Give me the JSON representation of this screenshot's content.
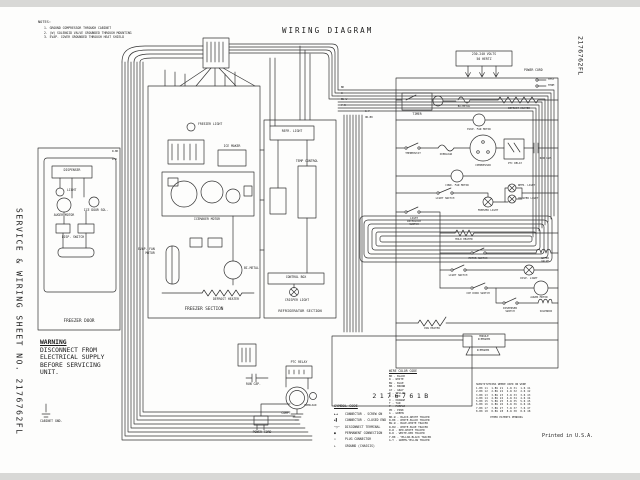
{
  "page": {
    "title": "WIRING DIAGRAM",
    "side_left": "SERVICE & WIRING SHEET NO. 2176762FL",
    "side_right": "2176762FL",
    "printed": "Printed in U.S.A.",
    "diagram_number": "2176761B"
  },
  "notes": {
    "heading": "NOTES:",
    "items": [
      "1. GROUND COMPRESSOR THROUGH CABINET",
      "2. (W) SOLENOID VALVE GROUNDED THROUGH MOUNTING",
      "3. EVAP. COVER GROUNDED THROUGH HEAT SHIELD"
    ]
  },
  "warning": {
    "title": "WARNING",
    "lines": "DISCONNECT FROM\nELECTRICAL SUPPLY\nBEFORE SERVICING\nUNIT."
  },
  "pictorial": {
    "freezer_door": {
      "title": "FREEZER DOOR",
      "dispenser": "DISPENSER",
      "light": "LIGHT",
      "auger": "AUGER MOTOR",
      "ice_door": "ICE DOOR SOL.",
      "switch": "DISP. SWITCH"
    },
    "freezer_section": {
      "title": "FREEZER SECTION",
      "light": "FREEZER LIGHT",
      "ice_maker": "ICE MAKER",
      "module": "ICEMAKER MOTOR",
      "evap_fan": "EVAP. FAN\nMOTOR",
      "bimetal": "BI-METAL",
      "defrost_heater": "DEFROST HEATER"
    },
    "refrigerator_section": {
      "title": "REFRIGERATOR SECTION",
      "light": "REFR. LIGHT",
      "temp_control": "TEMP CONTROL",
      "control_box": "CONTROL BOX",
      "crisper": "CRISPER LIGHT"
    },
    "machine": {
      "ptc": "PTC RELAY",
      "run_cap": "RUN CAP.",
      "comp": "COMP.",
      "overload": "OVERLOAD",
      "power_cord": "POWER CORD",
      "cabinet_gnd": "CABINET GND."
    }
  },
  "schematic": {
    "volts1": "230-240 VOLTS",
    "volts2": "50 HERTZ",
    "power_cord": "POWER CORD",
    "test": "TEST",
    "term": "TERM",
    "timer": "TIMER",
    "bimetal": "BI-METAL",
    "defrost_heater": "DEFROST HEATER",
    "evap_fan": "EVAP. FAN MOTOR",
    "thermostat": "THERMOSTAT",
    "overload": "OVERLOAD",
    "compressor": "COMPRESSOR",
    "ptc": "PTC RELAY",
    "run_cap": "RUN CAP.",
    "cond_fan": "COND. FAN MOTOR",
    "light_switch": "LIGHT SWITCH",
    "freezer_light": "FREEZER LIGHT",
    "refr_light": "REFR. LIGHT",
    "crisper_light": "CRISPER LIGHT",
    "interlock": "LIGHT\nINTERLOCK\nSWITCH",
    "mold_heater": "MOLD HEATER",
    "motor_switch": "MOTOR SWITCH",
    "water_valve": "WATER\nVALVE",
    "light_switch2": "LIGHT SWITCH",
    "disp_light": "DISP. LIGHT",
    "ice_door_switch": "ICE DOOR SWITCH",
    "auger": "AUGER MOTOR",
    "disp_switch": "DISPENSER\nSWITCH",
    "solenoid": "SOLENOID",
    "pan_heater": "PAN HEATER",
    "module_box": "MODULE\nICEMAKER",
    "icemaker": "ICEMAKER"
  },
  "legend": {
    "symbol_code": {
      "header": "SYMBOL CODE",
      "items": [
        {
          "sym": "►◄",
          "text": "CONNECTOR - SCREW ON"
        },
        {
          "sym": "►▌",
          "text": "CONNECTOR - CLOSED END"
        },
        {
          "sym": "─○─",
          "text": "DISCONNECT TERMINAL"
        },
        {
          "sym": "●",
          "text": "PERMANENT CONNECTION"
        },
        {
          "sym": "▭",
          "text": "PLUG CONNECTOR"
        },
        {
          "sym": "⊥",
          "text": "GROUND (CHASSIS)"
        }
      ]
    },
    "wire_color": {
      "header": "WIRE COLOR CODE",
      "items": [
        "BK - BLACK",
        "W - WHITE",
        "BU - BLUE",
        "BR - BROWN",
        "GY - GRAY",
        "Y - YELLOW",
        "R - RED",
        "O - ORANGE",
        "T - TAN",
        "P - PURPLE",
        "PK - PINK",
        "G - GREEN",
        "BK-W - BLACK-WHITE TRACER",
        "W-BK - WHITE-BLACK TRACER",
        "BU-W - BLUE-WHITE TRACER",
        "W-BU - WHITE-BLUE TRACER",
        "R-W - RED-WHITE TRACER",
        "W-R - WHITE-RED TRACER",
        "Y-BK - YELLOW-BLACK TRACER",
        "G-Y - GREEN-YELLOW TRACER"
      ]
    },
    "subs": {
      "header": "SUBSTITUTIONS WHERE USED ON WIRE",
      "rows": [
        "1-BK 11  1-BU 21  1-W 31  1-R 41",
        "2-BK 12  2-BU 22  2-W 32  2-R 42",
        "3-BK 13  3-BU 23  3-W 33  3-R 43",
        "4-BK 14  4-BU 24  4-W 34  4-R 44",
        "5-BK 15  5-BU 25  5-W 35  5-R 45",
        "6-BK 16  6-BU 26  6-W 36  6-R 46",
        "7-BK 17  7-BU 27  7-W 37  7-R 47",
        "8-BK 18  8-BU 28  8-W 38  8-R 48"
      ],
      "footer": "OTHER PATENTS PENDING"
    }
  },
  "wire_tags": [
    "BK",
    "W",
    "BU-W",
    "Y-R",
    "G-Y",
    "OR-BK",
    "W-BK",
    "R-W"
  ]
}
